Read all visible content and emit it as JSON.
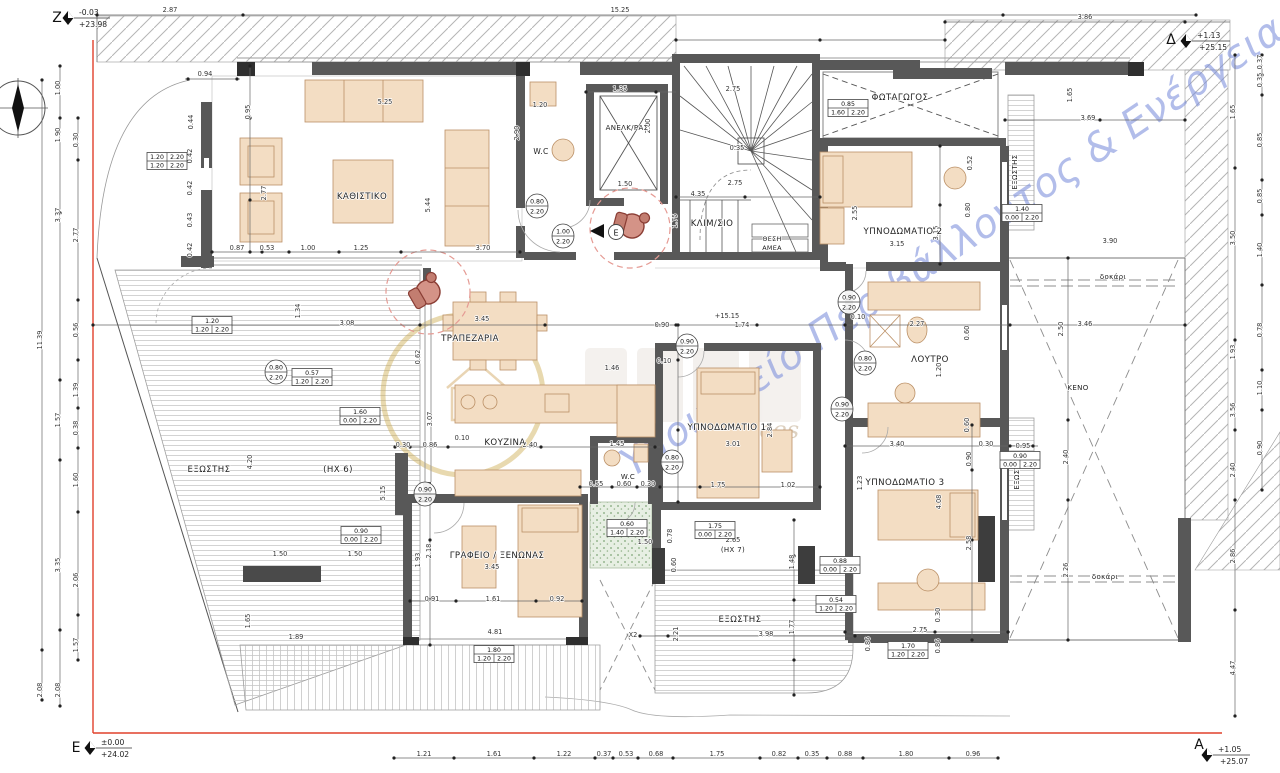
{
  "markers": {
    "z": {
      "letter": "Z",
      "v1": "-0.03",
      "v2": "+23.98"
    },
    "delta": {
      "letter": "Δ",
      "v1": "+1.13",
      "v2": "+25.15"
    },
    "e": {
      "letter": "E",
      "v1": "±0.00",
      "v2": "+24.02"
    },
    "a": {
      "letter": "A",
      "v1": "+1.05",
      "v2": "+25.07"
    }
  },
  "entry_arrow": {
    "label": "E"
  },
  "watermark": {
    "ministry": "Υπουργείο Περιβάλλοντος & Ενέργειας",
    "tagline": "services"
  },
  "rooms": [
    {
      "t": "ΚΑΘΙΣΤΙΚΟ",
      "x": 362,
      "y": 199
    },
    {
      "t": "W.C",
      "x": 541,
      "y": 154,
      "fs": 7.5
    },
    {
      "t": "ΑΝΕΛΚ/ΡΑΣ",
      "x": 627,
      "y": 130,
      "fs": 7
    },
    {
      "t": "ΚΛΙΜ/ΣΙΟ",
      "x": 712,
      "y": 226
    },
    {
      "t": "ΘΕΣΗ",
      "x": 772,
      "y": 241,
      "fs": 6.4
    },
    {
      "t": "ΑΜΕΑ",
      "x": 772,
      "y": 250,
      "fs": 6.4
    },
    {
      "t": "ΦΩΤΑΓΩΓΟΣ",
      "x": 900,
      "y": 100
    },
    {
      "t": "ΥΠΝΟΔΩΜΑΤΙΟ 2",
      "x": 903,
      "y": 234
    },
    {
      "t": "ΤΡΑΠΕΖΑΡΙΑ",
      "x": 470,
      "y": 341
    },
    {
      "t": "ΚΟΥΖΙΝΑ",
      "x": 505,
      "y": 445
    },
    {
      "t": "W.C",
      "x": 628,
      "y": 479,
      "fs": 7
    },
    {
      "t": "ΥΠΝΟΔΩΜΑΤΙΟ 1",
      "x": 727,
      "y": 430
    },
    {
      "t": "ΛΟΥΤΡΟ",
      "x": 930,
      "y": 362
    },
    {
      "t": "ΥΠΝΟΔΩΜΑΤΙΟ 3",
      "x": 905,
      "y": 485
    },
    {
      "t": "ΓΡΑΦΕΙΟ / ΞΕΝΩΝΑΣ",
      "x": 497,
      "y": 558
    },
    {
      "t": "ΕΞΩΣΤΗΣ",
      "x": 209,
      "y": 472
    },
    {
      "t": "(ΗΧ 6)",
      "x": 338,
      "y": 472
    },
    {
      "t": "ΕΞΩΣΤΗΣ",
      "x": 740,
      "y": 622
    },
    {
      "t": "(ΗΧ 7)",
      "x": 733,
      "y": 552,
      "fs": 7
    },
    {
      "t": "ΕΞΩΣΤΗΣ",
      "x": 1017,
      "y": 172,
      "r": 1,
      "fs": 7
    },
    {
      "t": "ΕΞΩΣΤΗΣ",
      "x": 1019,
      "y": 472,
      "r": 1,
      "fs": 7
    },
    {
      "t": "ΚΕΝΟ",
      "x": 1078,
      "y": 390,
      "fs": 7
    },
    {
      "t": "δοκάρι",
      "x": 1113,
      "y": 279,
      "fs": 7
    },
    {
      "t": "δοκάρι",
      "x": 1105,
      "y": 579,
      "fs": 7
    }
  ],
  "dims": [
    {
      "t": "2.87",
      "x": 170,
      "y": 12
    },
    {
      "t": "15.25",
      "x": 620,
      "y": 12
    },
    {
      "t": "3.86",
      "x": 1085,
      "y": 19
    },
    {
      "t": "0.94",
      "x": 205,
      "y": 76
    },
    {
      "t": "0.95",
      "x": 250,
      "y": 112,
      "r": 1
    },
    {
      "t": "5.25",
      "x": 385,
      "y": 104
    },
    {
      "t": "2.77",
      "x": 266,
      "y": 193,
      "r": 1
    },
    {
      "t": "5.44",
      "x": 430,
      "y": 205,
      "r": 1
    },
    {
      "t": "0.87",
      "x": 237,
      "y": 250
    },
    {
      "t": "0.53",
      "x": 267,
      "y": 250
    },
    {
      "t": "1.00",
      "x": 308,
      "y": 250
    },
    {
      "t": "1.25",
      "x": 361,
      "y": 250
    },
    {
      "t": "3.70",
      "x": 483,
      "y": 250
    },
    {
      "t": "1.20",
      "x": 540,
      "y": 107
    },
    {
      "t": "2.90",
      "x": 519,
      "y": 133,
      "r": 1
    },
    {
      "t": "1.35",
      "x": 620,
      "y": 91
    },
    {
      "t": "2.75",
      "x": 733,
      "y": 91
    },
    {
      "t": "2.00",
      "x": 650,
      "y": 126,
      "r": 1
    },
    {
      "t": "1.50",
      "x": 625,
      "y": 186
    },
    {
      "t": "4.35",
      "x": 698,
      "y": 196
    },
    {
      "t": "2.75",
      "x": 735,
      "y": 185
    },
    {
      "t": "1.75",
      "x": 677,
      "y": 221,
      "r": 1
    },
    {
      "t": "0.35",
      "x": 737,
      "y": 150
    },
    {
      "t": "3.69",
      "x": 1088,
      "y": 120
    },
    {
      "t": "1.65",
      "x": 1072,
      "y": 95,
      "r": 1
    },
    {
      "t": "3.08",
      "x": 347,
      "y": 325
    },
    {
      "t": "1.34",
      "x": 300,
      "y": 311,
      "r": 1
    },
    {
      "t": "3.45",
      "x": 482,
      "y": 321
    },
    {
      "t": "0.90",
      "x": 662,
      "y": 327
    },
    {
      "t": "1.74",
      "x": 742,
      "y": 327
    },
    {
      "t": "+15.15",
      "x": 727,
      "y": 318
    },
    {
      "t": "0.62",
      "x": 420,
      "y": 357,
      "r": 1
    },
    {
      "t": "3.07",
      "x": 432,
      "y": 419,
      "r": 1
    },
    {
      "t": "0.30",
      "x": 403,
      "y": 447
    },
    {
      "t": "0.86",
      "x": 430,
      "y": 447
    },
    {
      "t": "0.10",
      "x": 462,
      "y": 440
    },
    {
      "t": "2.40",
      "x": 530,
      "y": 447
    },
    {
      "t": "1.46",
      "x": 612,
      "y": 370
    },
    {
      "t": "0.10",
      "x": 664,
      "y": 363
    },
    {
      "t": "1.45",
      "x": 617,
      "y": 446
    },
    {
      "t": "0.55",
      "x": 596,
      "y": 486
    },
    {
      "t": "0.60",
      "x": 624,
      "y": 486
    },
    {
      "t": "0.30",
      "x": 648,
      "y": 486
    },
    {
      "t": "1.75",
      "x": 718,
      "y": 487
    },
    {
      "t": "1.02",
      "x": 788,
      "y": 487
    },
    {
      "t": "3.01",
      "x": 733,
      "y": 446
    },
    {
      "t": "2.84",
      "x": 772,
      "y": 430,
      "r": 1
    },
    {
      "t": "2.55",
      "x": 857,
      "y": 213,
      "r": 1
    },
    {
      "t": "3.15",
      "x": 897,
      "y": 246
    },
    {
      "t": "3.15",
      "x": 938,
      "y": 233,
      "r": 1
    },
    {
      "t": "0.52",
      "x": 972,
      "y": 163,
      "r": 1
    },
    {
      "t": "0.80",
      "x": 970,
      "y": 210,
      "r": 1
    },
    {
      "t": "0.10",
      "x": 858,
      "y": 319
    },
    {
      "t": "2.27",
      "x": 917,
      "y": 326
    },
    {
      "t": "1.20",
      "x": 941,
      "y": 370,
      "r": 1
    },
    {
      "t": "0.60",
      "x": 969,
      "y": 333,
      "r": 1
    },
    {
      "t": "0.60",
      "x": 969,
      "y": 425,
      "r": 1
    },
    {
      "t": "3.46",
      "x": 1085,
      "y": 326
    },
    {
      "t": "2.50",
      "x": 1063,
      "y": 329,
      "r": 1
    },
    {
      "t": "3.90",
      "x": 1110,
      "y": 243
    },
    {
      "t": "2.40",
      "x": 1068,
      "y": 457,
      "r": 1
    },
    {
      "t": "2.26",
      "x": 1068,
      "y": 570,
      "r": 1
    },
    {
      "t": "3.40",
      "x": 897,
      "y": 446
    },
    {
      "t": "0.30",
      "x": 986,
      "y": 446
    },
    {
      "t": "0.95",
      "x": 1023,
      "y": 448
    },
    {
      "t": "0.90",
      "x": 971,
      "y": 459,
      "r": 1
    },
    {
      "t": "1.23",
      "x": 862,
      "y": 483,
      "r": 1
    },
    {
      "t": "4.08",
      "x": 941,
      "y": 502,
      "r": 1
    },
    {
      "t": "2.58",
      "x": 971,
      "y": 543,
      "r": 1
    },
    {
      "t": "2.75",
      "x": 920,
      "y": 632
    },
    {
      "t": "0.30",
      "x": 940,
      "y": 615,
      "r": 1
    },
    {
      "t": "0.86",
      "x": 870,
      "y": 644,
      "r": 1
    },
    {
      "t": "0.86",
      "x": 940,
      "y": 646,
      "r": 1
    },
    {
      "t": "3.45",
      "x": 492,
      "y": 569
    },
    {
      "t": "0.91",
      "x": 432,
      "y": 601
    },
    {
      "t": "1.61",
      "x": 493,
      "y": 601
    },
    {
      "t": "0.92",
      "x": 557,
      "y": 601
    },
    {
      "t": "1.93",
      "x": 420,
      "y": 560,
      "r": 1
    },
    {
      "t": "2.18",
      "x": 431,
      "y": 551,
      "r": 1
    },
    {
      "t": "4.81",
      "x": 495,
      "y": 634
    },
    {
      "t": "1.89",
      "x": 296,
      "y": 639
    },
    {
      "t": "1.65",
      "x": 250,
      "y": 621,
      "r": 1
    },
    {
      "t": "4.20",
      "x": 252,
      "y": 462,
      "r": 1
    },
    {
      "t": "5.15",
      "x": 385,
      "y": 493,
      "r": 1
    },
    {
      "t": "1.50",
      "x": 280,
      "y": 556
    },
    {
      "t": "1.50",
      "x": 355,
      "y": 556
    },
    {
      "t": "3.98",
      "x": 766,
      "y": 636
    },
    {
      "t": "2.21",
      "x": 678,
      "y": 634,
      "r": 1
    },
    {
      "t": "1.77",
      "x": 794,
      "y": 627,
      "r": 1
    },
    {
      "t": "1.48",
      "x": 794,
      "y": 562,
      "r": 1
    },
    {
      "t": "2.65",
      "x": 733,
      "y": 542
    },
    {
      "t": "0.78",
      "x": 672,
      "y": 536,
      "r": 1
    },
    {
      "t": "0.60",
      "x": 676,
      "y": 565,
      "r": 1
    },
    {
      "t": "1.50",
      "x": 645,
      "y": 544
    },
    {
      "t": "X2",
      "x": 633,
      "y": 637
    },
    {
      "t": "1.21",
      "x": 424,
      "y": 756
    },
    {
      "t": "1.61",
      "x": 494,
      "y": 756
    },
    {
      "t": "1.22",
      "x": 564,
      "y": 756
    },
    {
      "t": "0.37",
      "x": 604,
      "y": 756
    },
    {
      "t": "0.53",
      "x": 626,
      "y": 756
    },
    {
      "t": "0.68",
      "x": 656,
      "y": 756
    },
    {
      "t": "1.75",
      "x": 717,
      "y": 756
    },
    {
      "t": "0.82",
      "x": 779,
      "y": 756
    },
    {
      "t": "0.35",
      "x": 812,
      "y": 756
    },
    {
      "t": "0.88",
      "x": 845,
      "y": 756
    },
    {
      "t": "1.80",
      "x": 906,
      "y": 756
    },
    {
      "t": "0.96",
      "x": 973,
      "y": 756
    },
    {
      "t": "11.39",
      "x": 42,
      "y": 340,
      "r": 1
    },
    {
      "t": "2.08",
      "x": 42,
      "y": 690,
      "r": 1
    },
    {
      "t": "1.00",
      "x": 60,
      "y": 88,
      "r": 1
    },
    {
      "t": "1.90",
      "x": 60,
      "y": 135,
      "r": 1
    },
    {
      "t": "3.37",
      "x": 60,
      "y": 215,
      "r": 1
    },
    {
      "t": "1.57",
      "x": 60,
      "y": 420,
      "r": 1
    },
    {
      "t": "3.35",
      "x": 60,
      "y": 565,
      "r": 1
    },
    {
      "t": "2.08",
      "x": 60,
      "y": 690,
      "r": 1
    },
    {
      "t": "0.30",
      "x": 78,
      "y": 140,
      "r": 1
    },
    {
      "t": "2.77",
      "x": 78,
      "y": 235,
      "r": 1
    },
    {
      "t": "0.56",
      "x": 78,
      "y": 330,
      "r": 1
    },
    {
      "t": "1.39",
      "x": 78,
      "y": 390,
      "r": 1
    },
    {
      "t": "0.38",
      "x": 78,
      "y": 428,
      "r": 1
    },
    {
      "t": "1.60",
      "x": 78,
      "y": 480,
      "r": 1
    },
    {
      "t": "2.06",
      "x": 78,
      "y": 580,
      "r": 1
    },
    {
      "t": "1.57",
      "x": 78,
      "y": 645,
      "r": 1
    },
    {
      "t": "0.44",
      "x": 193,
      "y": 122,
      "r": 1
    },
    {
      "t": "0.42",
      "x": 192,
      "y": 156,
      "r": 1
    },
    {
      "t": "0.42",
      "x": 192,
      "y": 188,
      "r": 1
    },
    {
      "t": "0.43",
      "x": 192,
      "y": 220,
      "r": 1
    },
    {
      "t": "0.42",
      "x": 192,
      "y": 250,
      "r": 1
    },
    {
      "t": "1.65",
      "x": 1235,
      "y": 112,
      "r": 1
    },
    {
      "t": "3.50",
      "x": 1235,
      "y": 238,
      "r": 1
    },
    {
      "t": "1.93",
      "x": 1235,
      "y": 352,
      "r": 1
    },
    {
      "t": "3.56",
      "x": 1235,
      "y": 410,
      "r": 1
    },
    {
      "t": "2.40",
      "x": 1235,
      "y": 470,
      "r": 1
    },
    {
      "t": "2.86",
      "x": 1235,
      "y": 556,
      "r": 1
    },
    {
      "t": "4.47",
      "x": 1235,
      "y": 668,
      "r": 1
    },
    {
      "t": "0.37",
      "x": 1262,
      "y": 62,
      "r": 1
    },
    {
      "t": "0.35",
      "x": 1262,
      "y": 80,
      "r": 1
    },
    {
      "t": "0.85",
      "x": 1262,
      "y": 140,
      "r": 1
    },
    {
      "t": "0.85",
      "x": 1262,
      "y": 196,
      "r": 1
    },
    {
      "t": "1.40",
      "x": 1262,
      "y": 250,
      "r": 1
    },
    {
      "t": "0.78",
      "x": 1262,
      "y": 330,
      "r": 1
    },
    {
      "t": "1.10",
      "x": 1262,
      "y": 388,
      "r": 1
    },
    {
      "t": "0.90",
      "x": 1262,
      "y": 448,
      "r": 1
    }
  ],
  "door_boxes": [
    {
      "x": 848,
      "y": 108,
      "top": "0.85",
      "bl": "1.60",
      "br": "2.20"
    },
    {
      "x": 1022,
      "y": 213,
      "top": "1.40",
      "bl": "0.00",
      "br": "2.20"
    },
    {
      "x": 212,
      "y": 325,
      "top": "1.20",
      "bl": "1.20",
      "br": "2.20"
    },
    {
      "x": 312,
      "y": 377,
      "top": "0.57",
      "bl": "1.20",
      "br": "2.20"
    },
    {
      "x": 360,
      "y": 416,
      "top": "1.60",
      "bl": "0.00",
      "br": "2.20"
    },
    {
      "x": 627,
      "y": 528,
      "top": "0.60",
      "bl": "1.40",
      "br": "2.20"
    },
    {
      "x": 715,
      "y": 530,
      "top": "1.75",
      "bl": "0.00",
      "br": "2.20"
    },
    {
      "x": 840,
      "y": 565,
      "top": "0.88",
      "bl": "0.00",
      "br": "2.20"
    },
    {
      "x": 836,
      "y": 604,
      "top": "0.54",
      "bl": "1.20",
      "br": "2.20"
    },
    {
      "x": 908,
      "y": 650,
      "top": "1.70",
      "bl": "1.20",
      "br": "2.20"
    },
    {
      "x": 494,
      "y": 654,
      "top": "1.80",
      "bl": "1.20",
      "br": "2.20"
    },
    {
      "x": 1020,
      "y": 460,
      "top": "0.90",
      "bl": "0.00",
      "br": "2.20"
    },
    {
      "x": 361,
      "y": 535,
      "top": "0.90",
      "bl": "0.00",
      "br": "2.20"
    },
    {
      "x": 167,
      "y": 161,
      "rows": [
        [
          "1.20",
          "2.20"
        ],
        [
          "1.20",
          "2.20"
        ]
      ]
    }
  ],
  "door_circles": [
    {
      "x": 537,
      "y": 206,
      "top": "0.80",
      "bot": "2.20"
    },
    {
      "x": 563,
      "y": 236,
      "top": "1.00",
      "bot": "2.20"
    },
    {
      "x": 276,
      "y": 372,
      "top": "0.80",
      "bot": "2.20"
    },
    {
      "x": 687,
      "y": 346,
      "top": "0.90",
      "bot": "2.20"
    },
    {
      "x": 842,
      "y": 409,
      "top": "0.90",
      "bot": "2.20"
    },
    {
      "x": 865,
      "y": 363,
      "top": "0.80",
      "bot": "2.20"
    },
    {
      "x": 425,
      "y": 494,
      "top": "0.90",
      "bot": "2.20"
    },
    {
      "x": 672,
      "y": 462,
      "top": "0.80",
      "bot": "2.20"
    },
    {
      "x": 849,
      "y": 302,
      "top": "0.90",
      "bot": "2.20"
    }
  ]
}
